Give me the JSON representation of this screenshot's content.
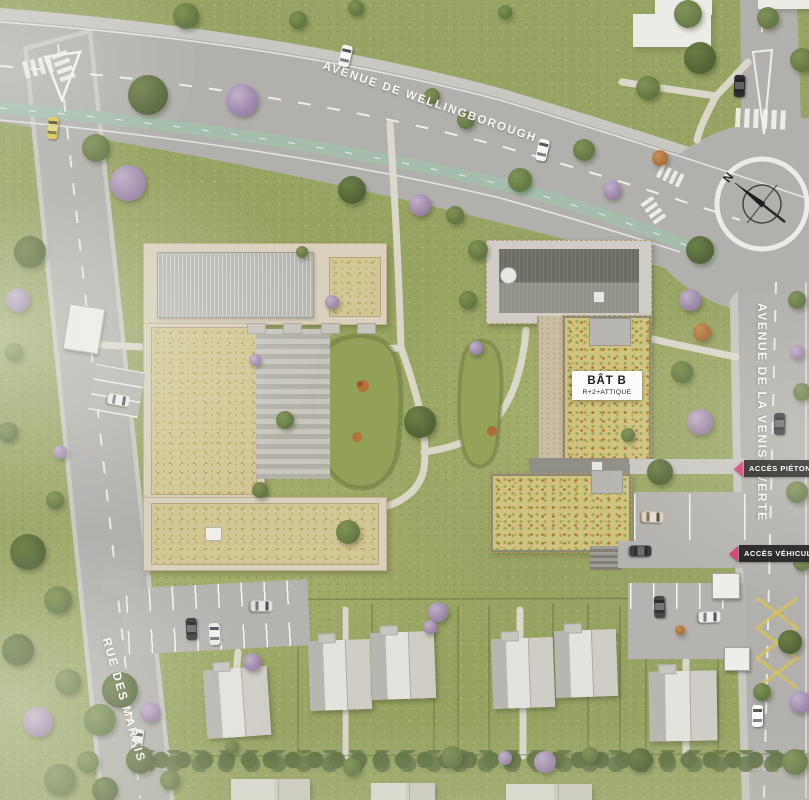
{
  "site_plan": {
    "roads": {
      "avenue_wellingborough": "AVENUE DE WELLINGBOROUGH",
      "avenue_venise_verte": "AVENUE DE LA VENISE VERTE",
      "rue_des_marais": "RUE DES MARAIS"
    },
    "buildings": {
      "bat_b": {
        "name": "BÂT B",
        "floors": "R+2+ATTIQUE"
      }
    },
    "access_labels": {
      "pedestrian": "ACCÈS PIÉTONS",
      "vehicles": "ACCÈS VÉHICULES"
    },
    "compass": {
      "north": "N"
    },
    "colors": {
      "badge_background": "#1d1d1b",
      "badge_text": "#ffffff",
      "access_arrow": "#d63a6e",
      "road": "#b2b0ac",
      "bike_lane": "#a4bdac",
      "grass": "#98a464",
      "green_roof": "#d2c794",
      "wildflower_roof": "#cfc37f",
      "metal_roof_dark": "#6e6e66",
      "metal_roof_light": "#b7b7b2",
      "label_text": "#fafaf7"
    }
  }
}
